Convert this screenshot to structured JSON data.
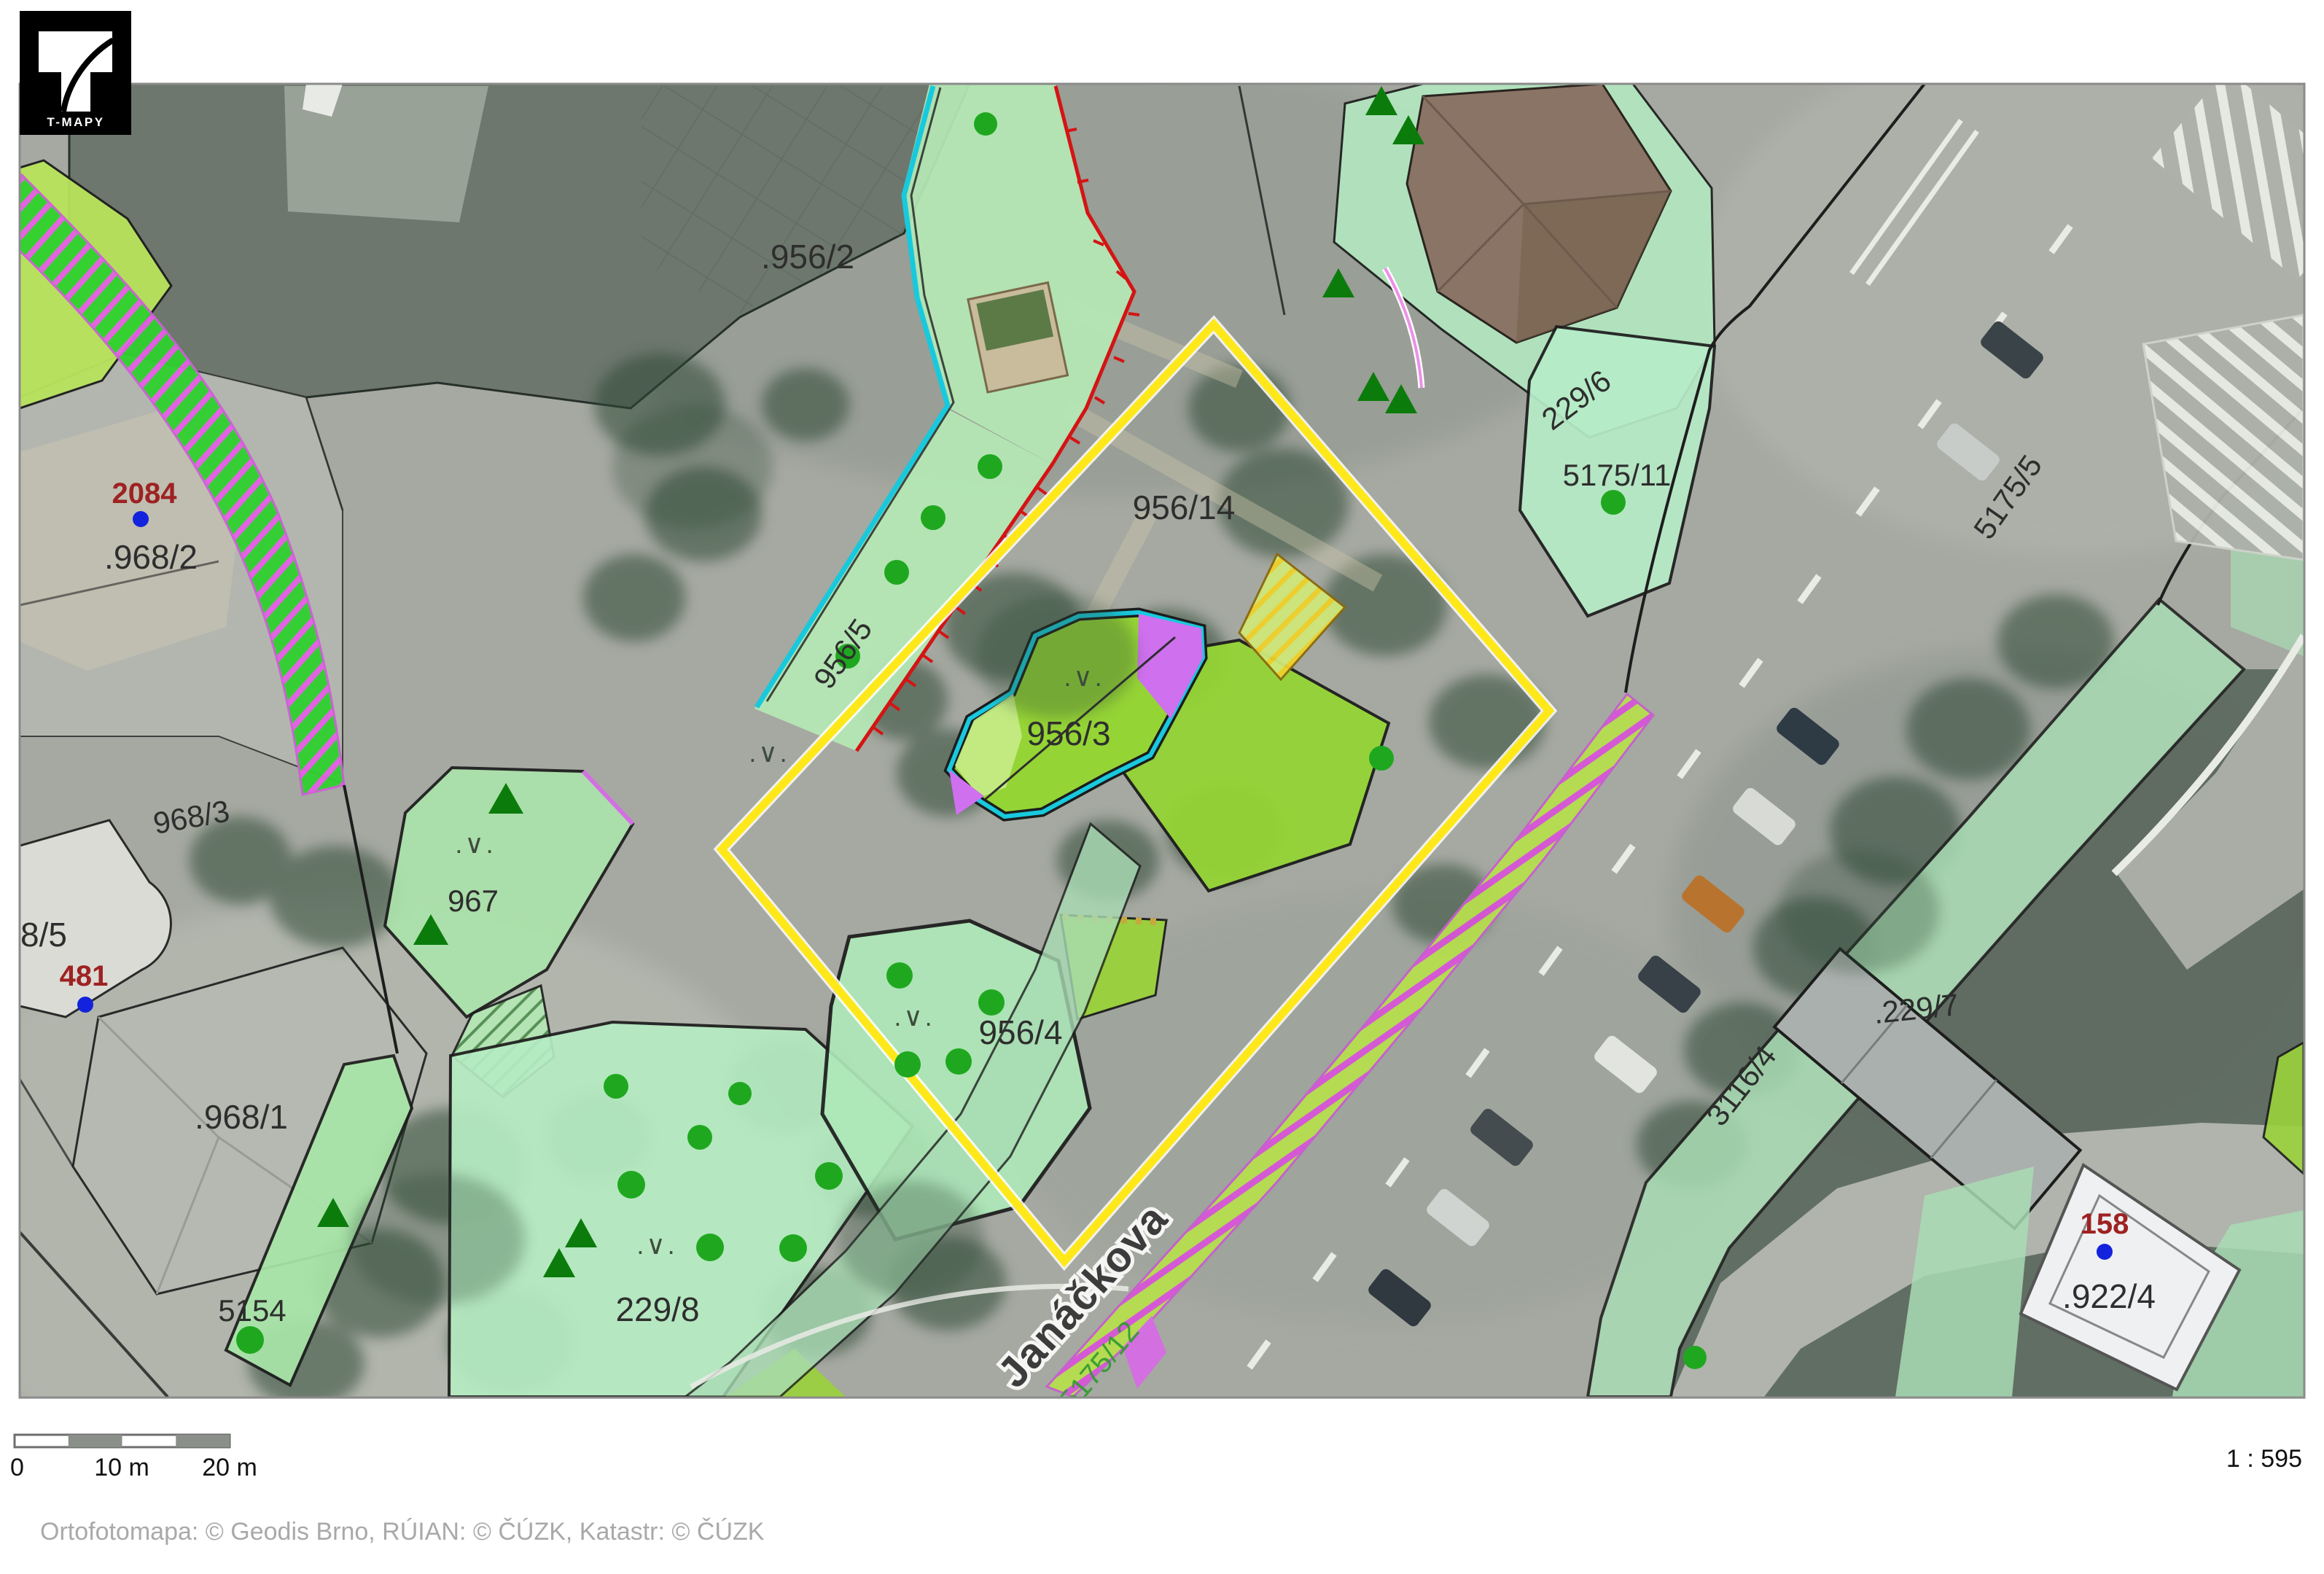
{
  "logo": {
    "text": "T-MAPY"
  },
  "footer": {
    "scale_ratio": "1 : 595",
    "scalebar": {
      "tick0": "0",
      "tick1": "10 m",
      "tick2": "20 m"
    },
    "attribution": "Ortofotomapa: © Geodis Brno, RÚIAN: © ČÚZK, Katastr: © ČÚZK"
  },
  "map": {
    "street": {
      "name": "Janáčkova"
    },
    "symbols": {
      "grass": ".∨."
    },
    "colors": {
      "selection": "#ffe81a",
      "cyan_boundary": "#18c9dd",
      "red_boundary": "#d41414",
      "mint_parcel": "#b3e7bd",
      "lime_parcel": "#95d435",
      "magenta_patch": "#cf70ef",
      "hatch_green": "#2fd12f",
      "tree_circle": "#1fa81f",
      "conifer": "#0b7c0b",
      "blue_point": "#1322dd"
    },
    "parcels": [
      {
        "label": ".956/2"
      },
      {
        "label": "956/5"
      },
      {
        "label": "956/14"
      },
      {
        "label": "956/3"
      },
      {
        "label": "956/4"
      },
      {
        "label": "229/8"
      },
      {
        "label": "967"
      },
      {
        "label": ".968/2"
      },
      {
        "label": "968/3"
      },
      {
        "label": ".968/1"
      },
      {
        "label": "5154"
      },
      {
        "label": "8/5"
      },
      {
        "label": "229/6"
      },
      {
        "label": "5175/11"
      },
      {
        "label": "5175/5"
      },
      {
        "label": "3116/4"
      },
      {
        "label": ".229/7"
      },
      {
        "label": ".922/4"
      },
      {
        "label": "5175/12"
      }
    ],
    "red_points": [
      {
        "label": "2084"
      },
      {
        "label": "481"
      },
      {
        "label": "158"
      }
    ]
  }
}
